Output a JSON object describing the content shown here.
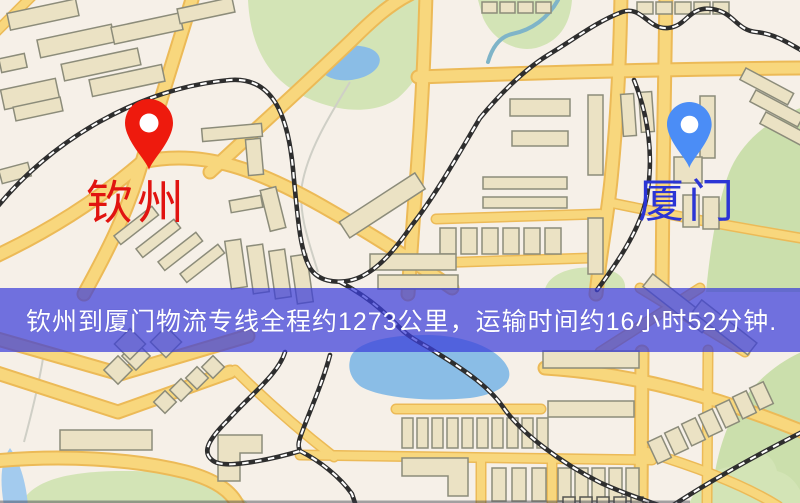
{
  "map": {
    "type": "static-route-map",
    "origin": {
      "label": "钦州",
      "pin_color": "#ee1a0d",
      "label_color": "#e11310"
    },
    "destination": {
      "label": "厦门",
      "pin_color": "#4b8df6",
      "label_color": "#2b35d5"
    },
    "banner": {
      "text": "钦州到厦门物流专线全程约1273公里，运输时间约16小时52分钟.",
      "background_color": "rgba(60,62,218,0.72)",
      "text_color": "#ffffff"
    },
    "route": {
      "distance_text": "约1273公里",
      "duration_text": "约16小时52分钟"
    },
    "palette": {
      "map_background": "#f6f0e8",
      "road_fill": "#f8d77d",
      "road_casing": "#ecba57",
      "building_fill": "#ebe2c4",
      "park_green": "#d3e4b6",
      "water_blue": "#8abde6",
      "railway_dark": "#2e2e2e"
    }
  }
}
